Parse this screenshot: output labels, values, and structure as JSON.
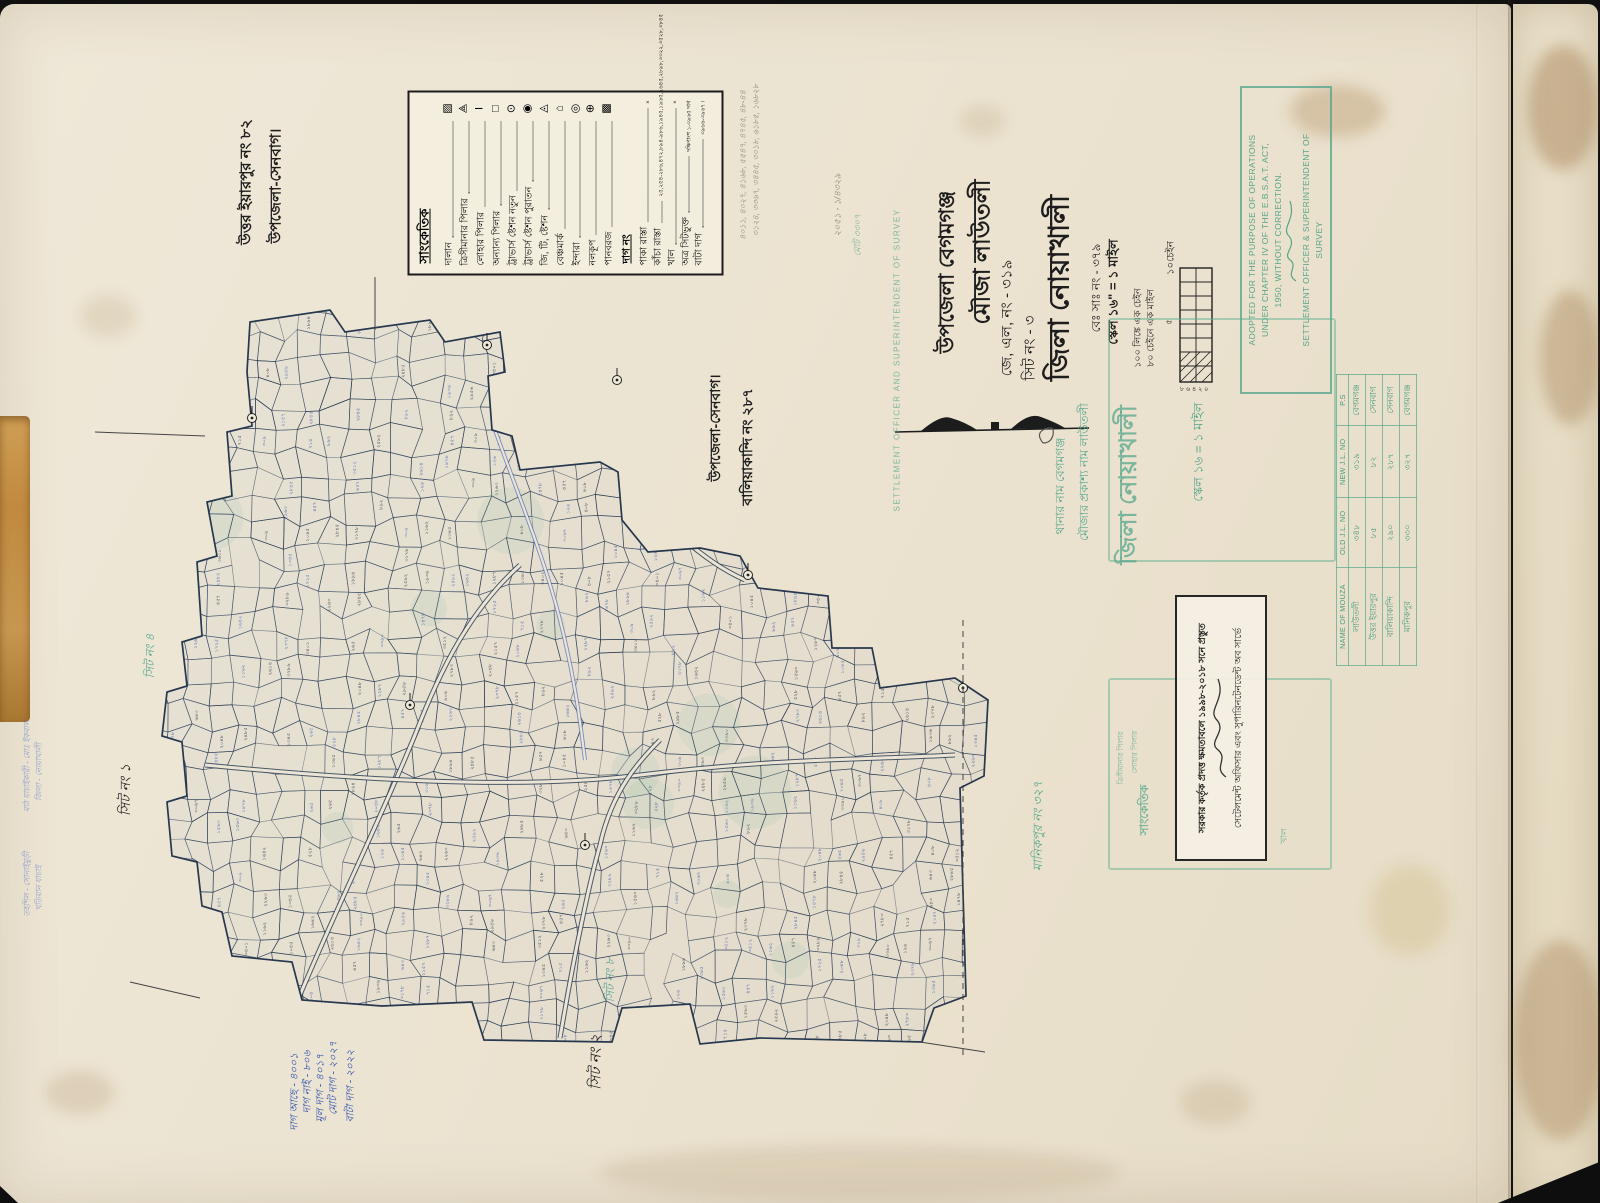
{
  "document": {
    "type": "scanned cadastral mouza map sheet",
    "district": "জিলা নোয়াখালী"
  },
  "legend": {
    "title": "সাংকেতিক",
    "items": [
      {
        "label": "দালান",
        "symbol": "▨",
        "icon": "building-hatched-rect"
      },
      {
        "label": "ত্রিসীমানার পিলার",
        "symbol": "⟁",
        "icon": "tri-junction-pillar"
      },
      {
        "label": "লোহার পিলার",
        "symbol": "I",
        "icon": "iron-pillar"
      },
      {
        "label": "অন্যান্য পিলার",
        "symbol": "□",
        "icon": "other-pillar"
      },
      {
        "label": "ট্রাভার্স ষ্টেশন নতুন",
        "symbol": "⊙",
        "icon": "traverse-station-new"
      },
      {
        "label": "ট্রাভার্স ষ্টেশন পুরাতন",
        "symbol": "◉",
        "icon": "traverse-station-old"
      },
      {
        "label": "জি, টি, ষ্টেশন",
        "symbol": "◬",
        "icon": "gt-station"
      },
      {
        "label": "বেঞ্চমার্ক",
        "symbol": "⌂",
        "icon": "benchmark"
      },
      {
        "label": "ইন্দারা",
        "symbol": "◎",
        "icon": "well"
      },
      {
        "label": "নলকূপ",
        "symbol": "⊕",
        "icon": "tubewell"
      },
      {
        "label": "পানবরজ",
        "symbol": "▩",
        "icon": "betel-garden"
      }
    ],
    "dag_header": "দাগ নং",
    "road_items": [
      {
        "label": "পাকা রাস্তা",
        "value": "×"
      },
      {
        "label": "কাঁচা রাস্তা",
        "value": "২৫,২৫৪-২৮৬,৪৭২,৮৯৪-৯৮৬,১৯৪৫,১৯৬৫,২৬৪৫,২৮৯৮,৩৩২২,৩৫২৮,৩৮৪৫"
      },
      {
        "label": "খাল",
        "value": "×"
      },
      {
        "label": "অত্র সিটভুক্ত",
        "value": "দক্ষিণাংশ ১-৩৯৬৫ দাগ"
      },
      {
        "label": "বাটা দাগ",
        "value": "৩৯৬৬-৩৯৬৭ ।"
      }
    ]
  },
  "title_block": {
    "upazila": "উপজেলা বেগমগঞ্জ",
    "mouza": "মৌজা লাউতলী",
    "jl_no": "জে, এল, নং - ৩১৯",
    "sheet_no": "সিট নং - ৩",
    "district": "জিলা নোয়াখালী",
    "be_sa_no": "বেঃ সাঃ নং - ৩৭৯",
    "scale": "স্কেল ১৬\" = ১ মাইল",
    "chain_note1": "১০০ লিঙ্কে এক চেইন",
    "chain_note2": "৮০ চেইনে এক মাইল",
    "scalebar_label": "১০চেইন",
    "scalebar_side": "৫",
    "scalebar_ticks": "৮ ৬ ৪ ২ ০"
  },
  "neighbor_labels": {
    "north_name": "উত্তর ইয়ারপুর নং ৮২",
    "north_sub": "উপজেলা-সেনবাগ।",
    "east_name": "বালিয়াকান্দি নং ২৮৭",
    "east_sub": "উপজেলা-সেনবাগ।",
    "south_name": "মানিকপুর নং ৩২৭"
  },
  "sheet_labels": {
    "black1": "সিট নং ১",
    "black2": "সিট নং ২",
    "green4": "সিট নং ৪",
    "green8": "সিট নং ৮"
  },
  "stamps": {
    "english": {
      "line1": "ADOPTED FOR THE PURPOSE OF OPERATIONS",
      "line2": "UNDER CHAPTER IV OF THE E.B.S.A.T. ACT,",
      "line3": "1950, WITHOUT CORRECTION.",
      "footer1": "SETTLEMENT OFFICER & SUPERINTENDENT OF",
      "footer2": "SURVEY"
    },
    "authority": {
      "line1": "সরকার কর্তৃক প্রদত্ত ক্ষমতাবলে ১৯৯৮-২০১৮ সনে প্রস্তুত",
      "line2": "সেটেলমেন্ট অফিসার এবং সুপারিনটেনডেন্ট অব সার্ভে"
    },
    "thana": {
      "line1": "থানার নাম বেগমগঞ্জ",
      "line2": "মৌজার প্রকাশ্য নাম লাউতলী",
      "district": "জিলা নোয়াখালী",
      "scale": "স্কেল ১৬ = ১ মাইল"
    },
    "green_legend": {
      "title": "সাংকেতিক",
      "item1": "ত্রিসীমানার পিলার",
      "item2": "লোহার পিলার",
      "item3": "খাল"
    },
    "faint_english_vertical": "SETTLEMENT OFFICER AND SUPERINTENDENT OF SURVEY"
  },
  "mouza_table": {
    "headers": [
      "NAME OF MOUZA",
      "OLD J.L. NO",
      "NEW J.L. NO",
      "P.S"
    ],
    "rows": [
      [
        "লাউতলী",
        "৩৪৮",
        "৩১৯",
        "বেগমগঞ্জ"
      ],
      [
        "উত্তর ইয়ারপুর",
        "৮৫",
        "৮২",
        "সেনবাগ"
      ],
      [
        "বালিয়াকান্দি",
        "২৯০",
        "২৮৭",
        "সেনবাগ"
      ],
      [
        "মানিকপুর",
        "৩৩০",
        "৩২৭",
        "বেগমগঞ্জ"
      ]
    ]
  },
  "handwritten_notes": {
    "blue": [
      "দাগ আছে - ৪০০১",
      "দাগ নাই - ৮০৬",
      "মূল দাগ - ৪০১৭",
      "মোট দাগ - ২০২৭",
      "বাটা দাগ - ২০২২"
    ],
    "pencil1": "৪০১১, ৪০২৭, ৪১৬৮, ৫৫৪৭, ৪৭৪৫, ৪৮-৪৪",
    "pencil2": "৩১২৪, ৩৩৬৭, ৩৪৪৫, ৩০১৮, ৬১৮৫, ১৬৮২৮",
    "pencil3": "২০৫১ - ১/৪৩২৯",
    "pencil4": "মোট ৩৩০৭",
    "left_margin": [
      "মাঠ যাচাইকারী - মোঃ ইকবাল",
      "জিলা - নোয়াখালী",
      "তহশিল - সোনাইমুড়ী",
      "খতিয়ান যাচাই"
    ]
  },
  "map": {
    "description": "dense hand-drawn cadastral plot mesh with Bengali plot numbers",
    "ink_color": "#2e3f55",
    "number_colors": [
      "#3b57a8",
      "#2e3a4e",
      "#4a68b8",
      "#333c4d"
    ],
    "plot_number_samples": [
      "৪০৮",
      "১২৬",
      "২৬৫",
      "৩০৯",
      "৪৫৭",
      "৫২৮",
      "৬৪৩",
      "৭১৫",
      "৮৯২",
      "৯০৪",
      "১০৪৫",
      "১১৬২",
      "১২৮৭",
      "১৩৪৫",
      "১৪৭৮",
      "১৫৬৩",
      "১৬৪২",
      "১৭২৫",
      "১৮৯৪",
      "১৯৩৬",
      "২০৪৮",
      "২১৫৭",
      "২২৬৩",
      "২৩৭৮",
      "২৪৮৫",
      "২৫৯২",
      "২৬১৪",
      "২৭৮৩",
      "২৮৪৫",
      "২৯৫৬",
      "৩০৬৭",
      "৩১৭৮",
      "৩২৮৯",
      "৩৩৯০",
      "৩৪০১",
      "৩৫১২"
    ]
  }
}
